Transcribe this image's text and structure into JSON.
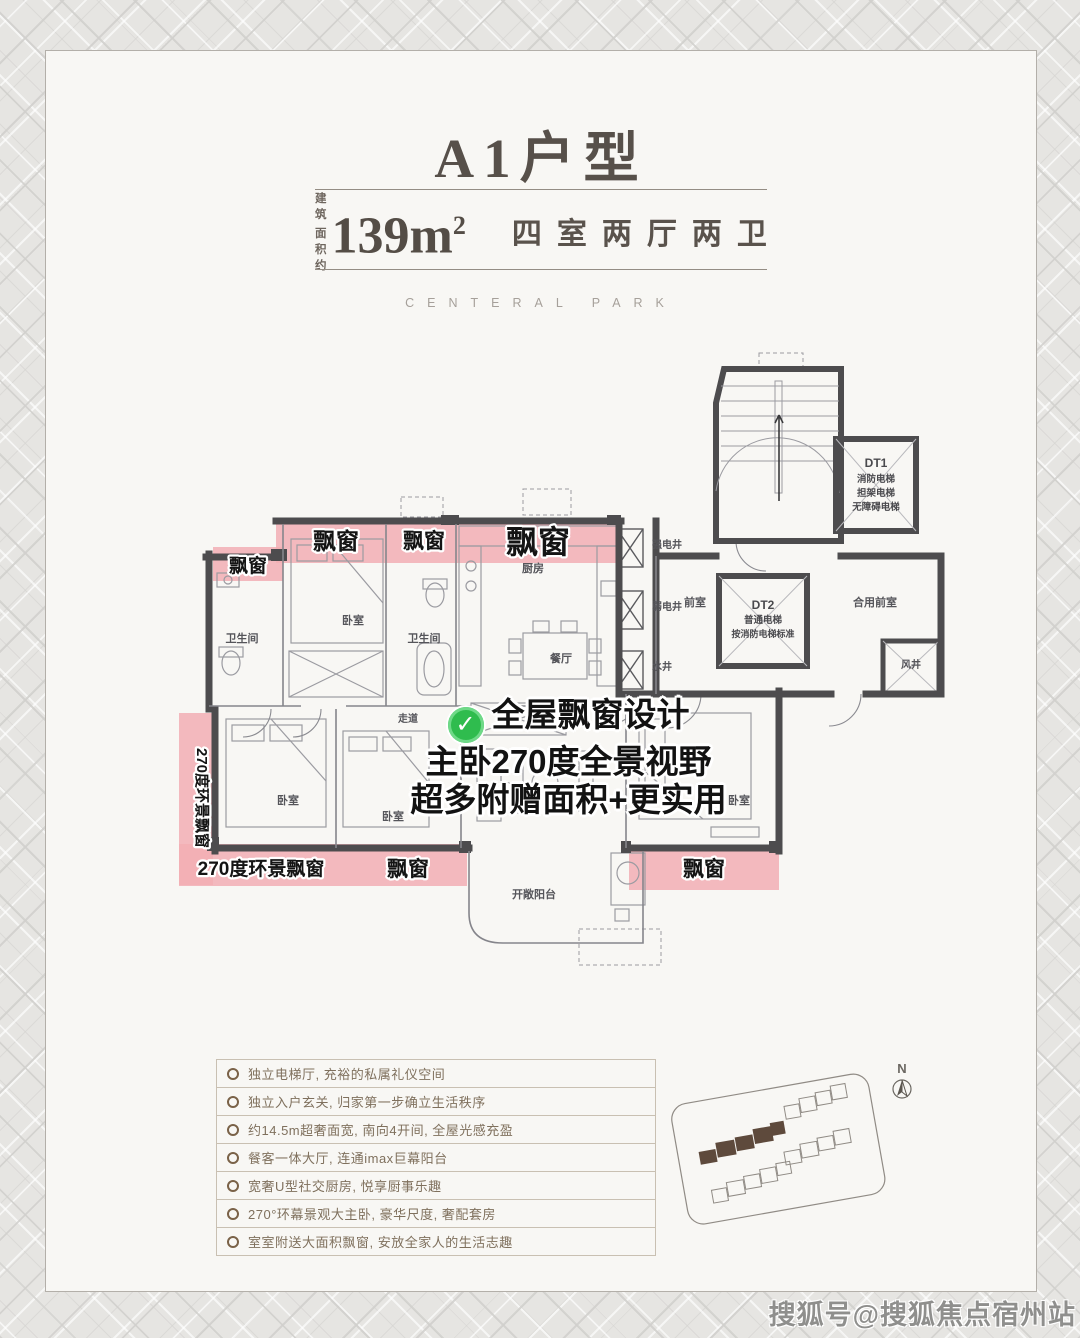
{
  "header": {
    "title": "A1户型",
    "area_label_top": "建 筑",
    "area_label_bottom": "面积约",
    "area_value": "139m",
    "area_sup": "2",
    "rooms_label": "四室两厅两卫",
    "brand": "CENTERAL PARK"
  },
  "plan": {
    "bay_window": "飘窗",
    "panorama_bay": "270度环景飘窗",
    "callout": {
      "line1": "全屋飘窗设计",
      "line2": "主卧270度全景视野",
      "line3": "超多附赠面积+更实用"
    },
    "rooms": {
      "bathroom": "卫生间",
      "bedroom": "卧室",
      "kitchen": "厨房",
      "dining": "餐厅",
      "corridor": "走道",
      "balcony": "开敞阳台",
      "strong_shaft": "强电井",
      "weak_shaft": "弱电井",
      "water_shaft": "水井",
      "wind_shaft": "风井",
      "front_room": "前室",
      "shared_front_room": "合用前室"
    },
    "dt1": {
      "name": "DT1",
      "line1": "消防电梯",
      "line2": "担架电梯",
      "line3": "无障碍电梯"
    },
    "dt2": {
      "name": "DT2",
      "line1": "普通电梯",
      "line2": "按消防电梯标准"
    },
    "check_glyph": "✓"
  },
  "features": {
    "items": [
      "独立电梯厅, 充裕的私属礼仪空间",
      "独立入户玄关, 归家第一步确立生活秩序",
      "约14.5m超奢面宽, 南向4开间, 全屋光感充盈",
      "餐客一体大厅, 连通imax巨幕阳台",
      "宽奢U型社交厨房, 悦享厨事乐趣",
      "270°环幕景观大主卧, 豪华尺度, 奢配套房",
      "室室附送大面积飘窗, 安放全家人的生活志趣"
    ]
  },
  "sitemap": {
    "compass": "N"
  },
  "watermark": "搜狐号@搜狐焦点宿州站",
  "colors": {
    "accent_pink": "#f2aeb4",
    "check_green": "#2fbc4e",
    "wall": "#4d4c4e",
    "title": "#57504a",
    "feature_brown": "#7f705d"
  }
}
